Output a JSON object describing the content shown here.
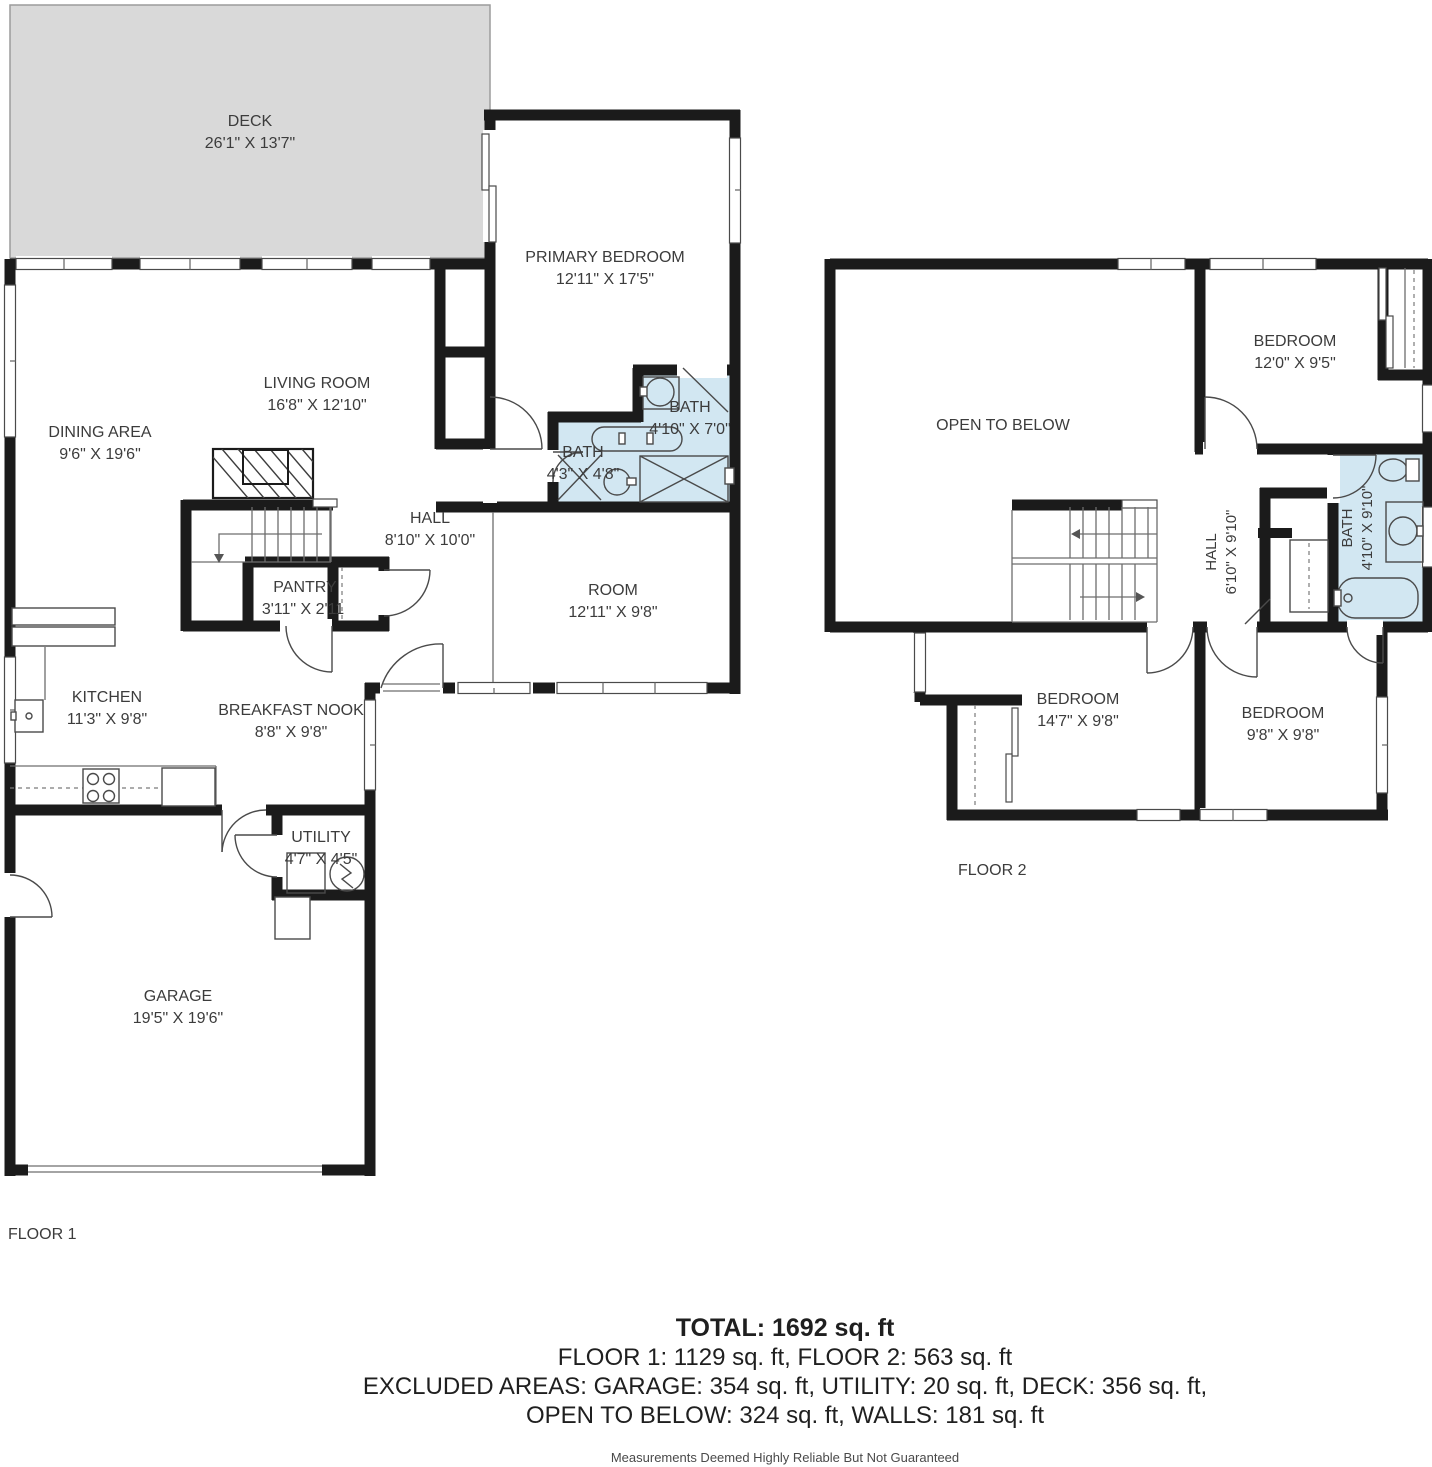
{
  "floor1": {
    "label": "FLOOR 1",
    "rooms": [
      {
        "name": "DECK",
        "dims": "26'1\" X 13'7\""
      },
      {
        "name": "PRIMARY BEDROOM",
        "dims": "12'11\" X 17'5\""
      },
      {
        "name": "LIVING ROOM",
        "dims": "16'8\" X 12'10\""
      },
      {
        "name": "DINING AREA",
        "dims": "9'6\" X 19'6\""
      },
      {
        "name": "BATH",
        "dims": "4'10\" X 7'0\""
      },
      {
        "name": "BATH",
        "dims": "4'3\" X 4'8\""
      },
      {
        "name": "HALL",
        "dims": "8'10\" X 10'0\""
      },
      {
        "name": "ROOM",
        "dims": "12'11\" X 9'8\""
      },
      {
        "name": "PANTRY",
        "dims": "3'11\" X 2'11"
      },
      {
        "name": "KITCHEN",
        "dims": "11'3\" X 9'8\""
      },
      {
        "name": "BREAKFAST NOOK",
        "dims": "8'8\" X 9'8\""
      },
      {
        "name": "UTILITY",
        "dims": "4'7\" X 4'5\""
      },
      {
        "name": "GARAGE",
        "dims": "19'5\" X 19'6\""
      }
    ]
  },
  "floor2": {
    "label": "FLOOR 2",
    "rooms": [
      {
        "name": "OPEN TO BELOW",
        "dims": ""
      },
      {
        "name": "BEDROOM",
        "dims": "12'0\" X 9'5\""
      },
      {
        "name": "HALL",
        "dims": "6'10\" X 9'10\""
      },
      {
        "name": "BATH",
        "dims": "4'10\" X 9'10\""
      },
      {
        "name": "BEDROOM",
        "dims": "14'7\" X 9'8\""
      },
      {
        "name": "BEDROOM",
        "dims": "9'8\" X 9'8\""
      }
    ]
  },
  "summary": {
    "total": "TOTAL: 1692 sq. ft",
    "floors": "FLOOR 1: 1129 sq. ft, FLOOR 2: 563 sq. ft",
    "excluded_line1": "EXCLUDED AREAS: GARAGE: 354 sq. ft, UTILITY: 20 sq. ft, DECK: 356 sq. ft,",
    "excluded_line2": "OPEN TO BELOW: 324 sq. ft, WALLS: 181 sq. ft",
    "disclaimer": "Measurements Deemed Highly Reliable But Not Guaranteed"
  },
  "colors": {
    "wall": "#1b1b1b",
    "bath_fill": "#d2e7f2",
    "deck_fill": "#d9d9d9",
    "text": "#3c3c3c"
  }
}
